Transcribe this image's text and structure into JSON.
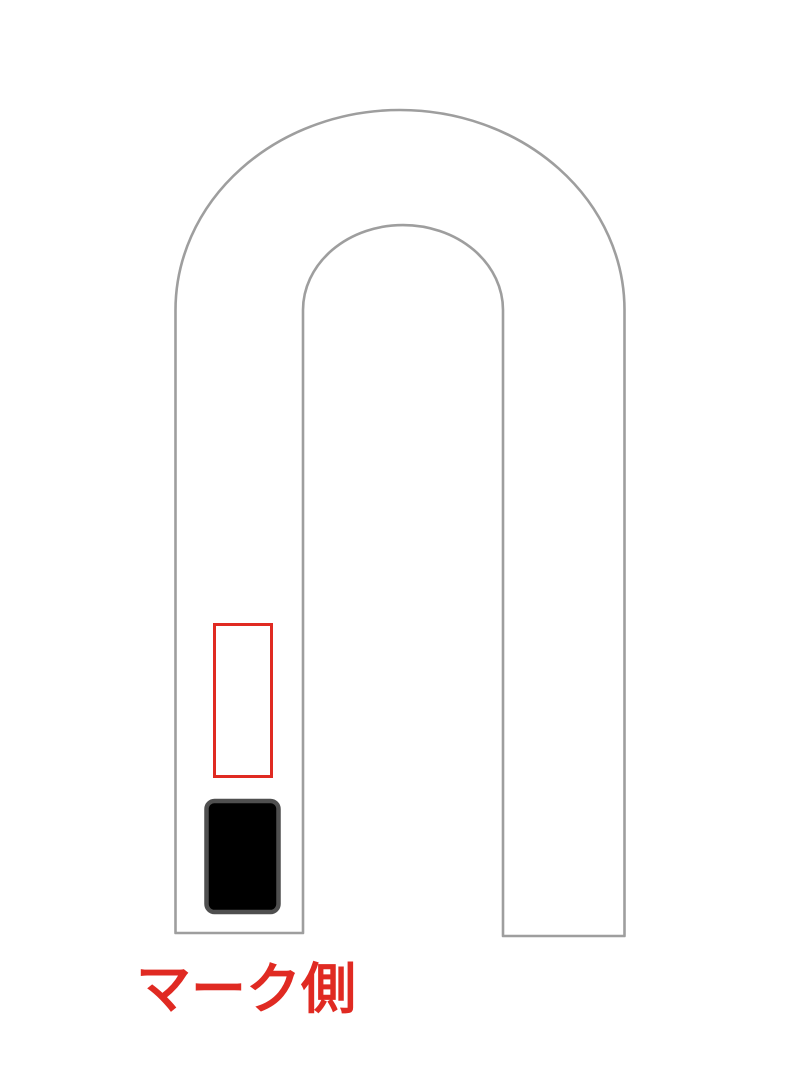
{
  "figure": {
    "type": "diagram",
    "subject": "u-shaped-band-with-mark-position",
    "label": {
      "text": "マーク側"
    },
    "shapes": {
      "u_band": "inverted-u-band-outline",
      "red_box": "mark-position-outline",
      "black_box": "mark-patch-filled"
    }
  },
  "colors": {
    "background": "#ffffff",
    "outline_gray": "#9e9e9e",
    "accent_red": "#e02a22",
    "mark_fill": "#000000",
    "mark_border": "#4f4f4f"
  }
}
